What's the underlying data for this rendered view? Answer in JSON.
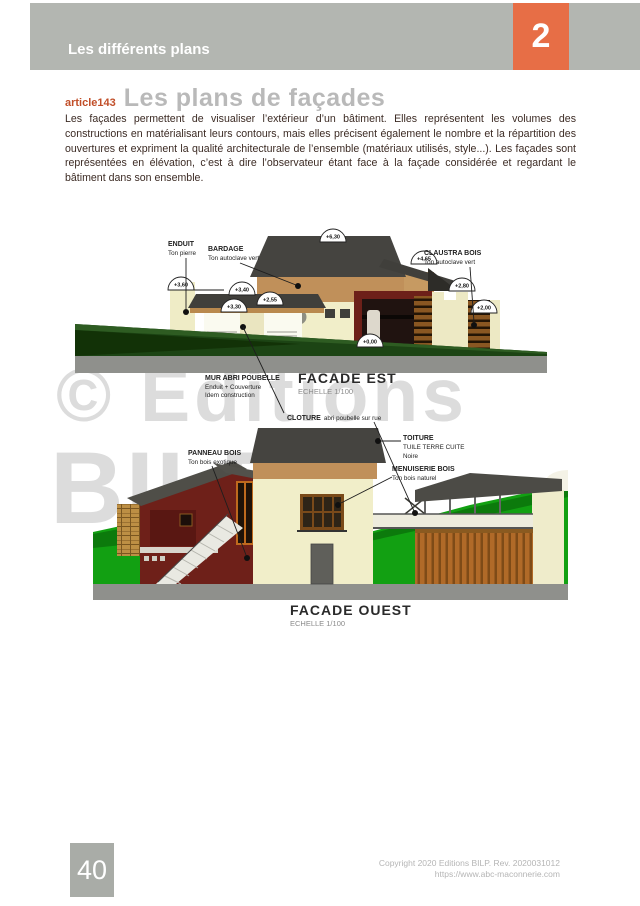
{
  "header": {
    "chapter_title": "Les différents plans",
    "chapter_number": "2"
  },
  "article": {
    "id": "article143",
    "title": "Les plans de façades",
    "body": "Les façades permettent de visualiser l’extérieur d’un bâtiment. Elles représentent les volumes des constructions en matérialisant leurs contours, mais elles précisent également le nombre et la répartition des ouvertures et expriment la qualité architecturale de l’ensemble (matériaux utilisés, style...). Les façades sont représentées en élévation, c’est à dire l’observateur étant face à la façade considérée et regardant le bâtiment dans son ensemble."
  },
  "watermark": {
    "line1": "© Editions",
    "line2": "BILP"
  },
  "facade_est": {
    "title": "FACADE EST",
    "scale": "ECHELLE 1/100",
    "markers": [
      "+6,30",
      "+4,65",
      "+3,60",
      "+3,40",
      "+3,30",
      "+2,55",
      "+2,80",
      "+2,00",
      "+0,00"
    ],
    "labels": {
      "enduit": {
        "title": "ENDUIT",
        "sub": "Ton pierre"
      },
      "bardage": {
        "title": "BARDAGE",
        "sub": "Ton autoclave vert"
      },
      "claustra": {
        "title": "CLAUSTRA BOIS",
        "sub": "Ton autoclave vert"
      },
      "mur_abri": {
        "title": "MUR ABRI POUBELLE",
        "sub1": "Enduit + Couverture",
        "sub2": "Idem construction"
      }
    }
  },
  "connector": {
    "cloture_title": "CLOTURE",
    "cloture_text": "abri poubelle sur rue"
  },
  "facade_ouest": {
    "title": "FACADE OUEST",
    "scale": "ECHELLE 1/100",
    "labels": {
      "panneau": {
        "title": "PANNEAU BOIS",
        "sub": "Ton bois exotique"
      },
      "toiture": {
        "title": "TOITURE",
        "sub1": "TUILE TERRE CUITE",
        "sub2": "Noire"
      },
      "menuiserie": {
        "title": "MENUISERIE BOIS",
        "sub": "Ton bois naturel"
      }
    }
  },
  "footer": {
    "page_number": "40",
    "copyright_line1": "Copyright 2020 Editions BILP. Rev. 2020031012",
    "copyright_line2": "https://www.abc-maconnerie.com"
  },
  "colors": {
    "accent_orange": "#e76e46",
    "header_gray": "#b3b6b1",
    "article_red": "#c14e28",
    "title_gray": "#b9b9b9",
    "body_text": "#3c2b24",
    "watermark": "#dcdcdc",
    "roof_gray": "#454440",
    "wall_cream": "#f1eec9",
    "bardage_tan": "#c0905a",
    "red_wall": "#6e2019",
    "wood": "#b06a28",
    "green_dark": "#1c4414",
    "green_bright": "#12a012",
    "base_gray": "#8f908c"
  }
}
